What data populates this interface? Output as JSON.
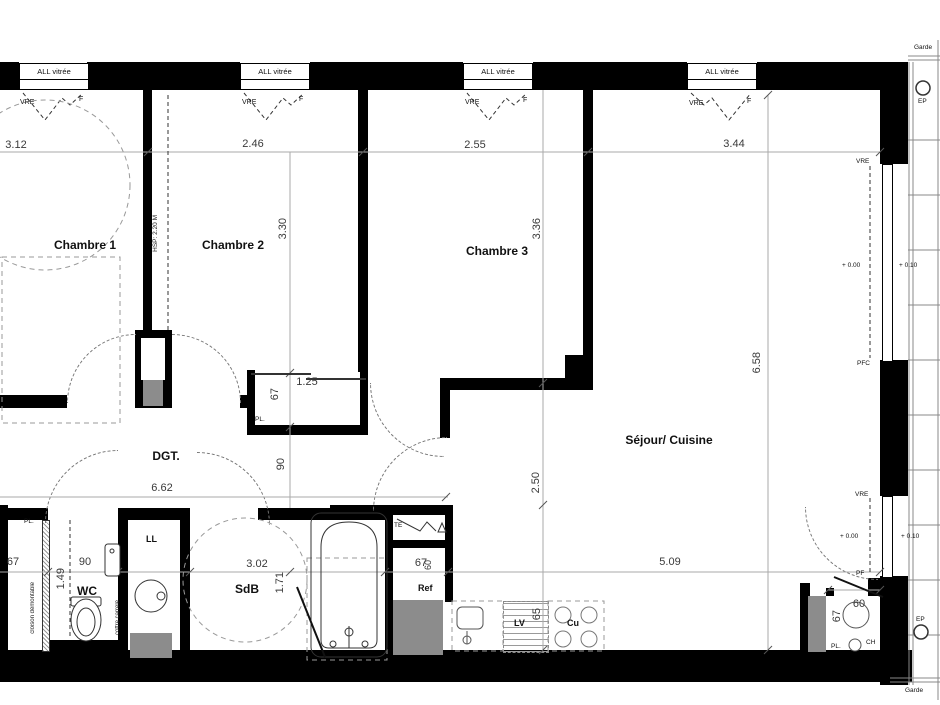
{
  "windows": {
    "label": "ALL vitrée",
    "vre": "VRE",
    "f": "F"
  },
  "rooms": {
    "chambre1": "Chambre 1",
    "chambre2": "Chambre 2",
    "chambre3": "Chambre 3",
    "sejour": "Séjour/ Cuisine",
    "sdb": "SdB",
    "wc": "WC",
    "dgt": "DGT."
  },
  "dims": {
    "ch1_w": "3.12",
    "ch2_w": "2.46",
    "ch3_w": "2.55",
    "sejour_w": "3.44",
    "ch2_h": "3.30",
    "ch3_h": "3.36",
    "sejour_h": "6.58",
    "sejour_d": "2.50",
    "kitchen_w": "5.09",
    "corridor_w": "6.62",
    "closet_w": "1.25",
    "closet_d": "67",
    "closet_front": "90",
    "left_closet_w": "67",
    "wc_w": "90",
    "wc_l": "1.49",
    "sdb_w": "3.02",
    "sdb_l": "1.71",
    "ref_w": "67",
    "ref_d": "60",
    "lv_d": "65",
    "ch_w": "60",
    "ch_d": "67"
  },
  "ann": {
    "hsp": "HSP: 2.20 M",
    "cloison": "cloison démontable",
    "coffre": "coffre carrelé",
    "pl": "PL.",
    "te": "TE",
    "ref": "Ref",
    "lv": "LV",
    "cu": "Cu",
    "ll": "LL",
    "ch": "CH",
    "ep": "EP",
    "garde": "Garde",
    "vre": "VRE",
    "pfc": "PFC",
    "pf": "PF",
    "level_in": "+ 0.00",
    "level_out": "+ 0.10"
  }
}
